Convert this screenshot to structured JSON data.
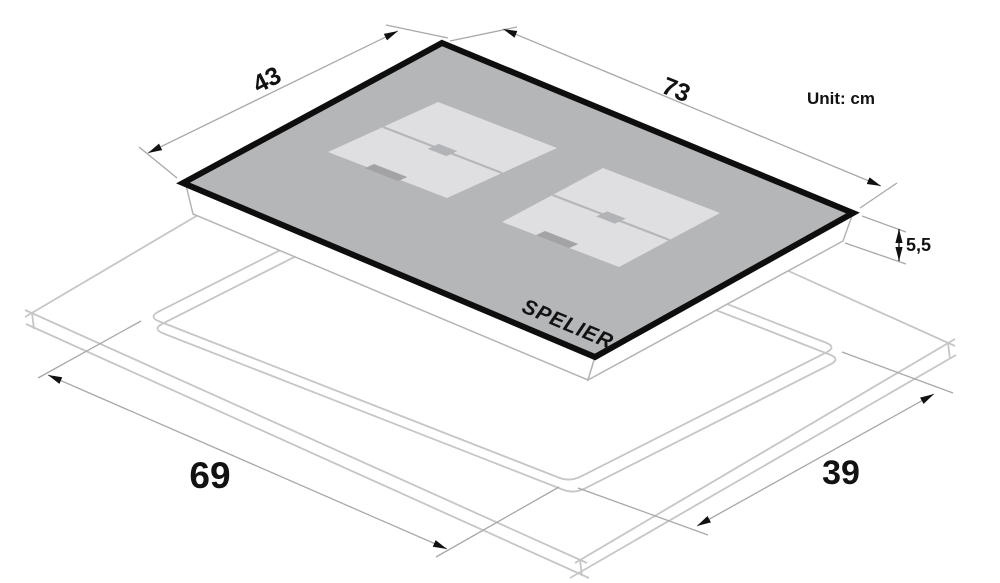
{
  "diagram": {
    "unit_label": "Unit: cm",
    "brand": "SPELIER",
    "dimensions": {
      "glass_width": "73",
      "glass_depth": "43",
      "body_height": "5,5",
      "cutout_width": "69",
      "cutout_depth": "39"
    },
    "colors": {
      "glass_fill": "#b5b6b8",
      "glass_border": "#0e0e0e",
      "zone_fill": "#dfdfe2",
      "zone_divider": "#b5b6b8",
      "zone_square": "#b2b3b6",
      "zone_marker": "#a3a3a6",
      "body_fill": "#ffffff",
      "body_stroke": "#b4b4b6",
      "worktop_stroke": "#c6c6c8",
      "dimension_stroke": "#a8a8aa",
      "arrow_fill": "#111111"
    }
  }
}
